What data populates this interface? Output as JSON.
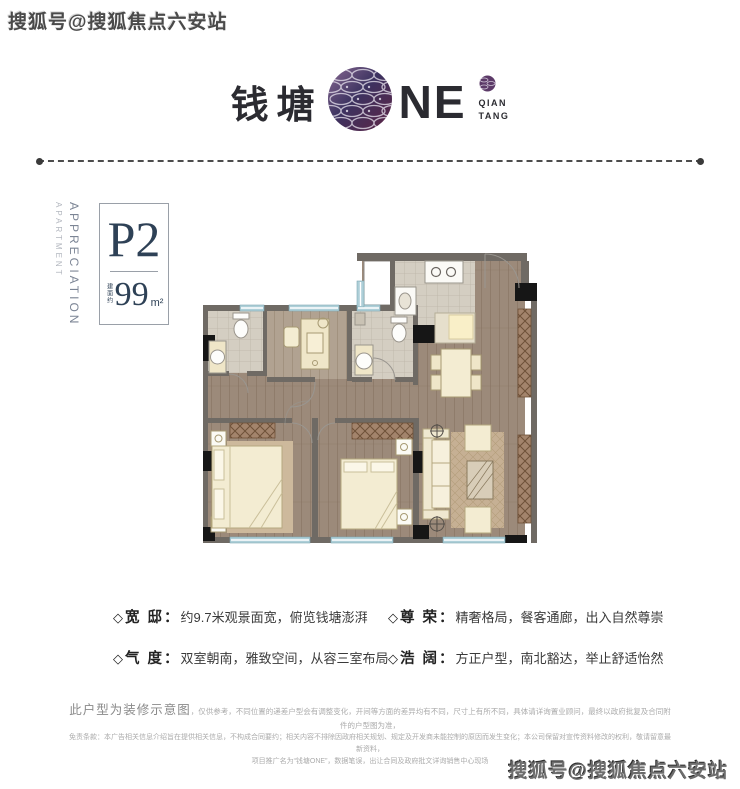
{
  "watermarks": {
    "top_left": "搜狐号@搜狐焦点六安站",
    "bottom_right": "搜狐号@搜狐焦点六安站"
  },
  "logo": {
    "cn": "钱塘",
    "en": "NE",
    "badge_line1": "QIAN",
    "badge_line2": "TANG"
  },
  "unit": {
    "side_label_top": "APARTMENT",
    "side_label_bottom": "APPRECIATION",
    "code": "P2",
    "area_prefix": "建面约",
    "area_value": "99",
    "area_unit": "m²"
  },
  "features": [
    {
      "diamond": "◇",
      "label": "宽 邸",
      "colon": "：",
      "desc": "约9.7米观景面宽，俯览钱塘澎湃"
    },
    {
      "diamond": "◇",
      "label": "气 度",
      "colon": "：",
      "desc": "双室朝南，雅致空间，从容三室布局"
    },
    {
      "diamond": "◇",
      "label": "尊 荣",
      "colon": "：",
      "desc": "精奢格局，餐客通廊，出入自然尊崇"
    },
    {
      "diamond": "◇",
      "label": "浩 阔",
      "colon": "：",
      "desc": "方正户型，南北豁达，举止舒适怡然"
    }
  ],
  "disclaimer": {
    "lead": "此户型为装修示意图",
    "line1_rest": "，仅供参考，不同位置的递差户型会有调整变化，开间等方面的差异均有不同，尺寸上有所不同，具体请详询置业顾问，最终以政府批复及合同附件的户型图为准，",
    "line2": "免责条款：本广告相关信息介绍旨在提供相关信息，不构成合同要约；相关内容不排除因政府相关规划、规定及开发商未能控制的原因而发生变化；本公司保留对宣传资料修改的权利，敬请留意最新资料，",
    "line3": "项目推广名为“钱塘ONE”，数据笔误，出让合同及政府批文详询销售中心现场"
  },
  "colors": {
    "accent_navy": "#2e4156",
    "logo_dark": "#2b2b31",
    "logo_purple": "#5c3a68",
    "logo_maroon": "#5d2444",
    "wall_gray": "#6f6a64",
    "wood_floor": "#9c8a7a",
    "window_blue": "#aecfd8",
    "fixture_cream": "#f3ecd2"
  }
}
